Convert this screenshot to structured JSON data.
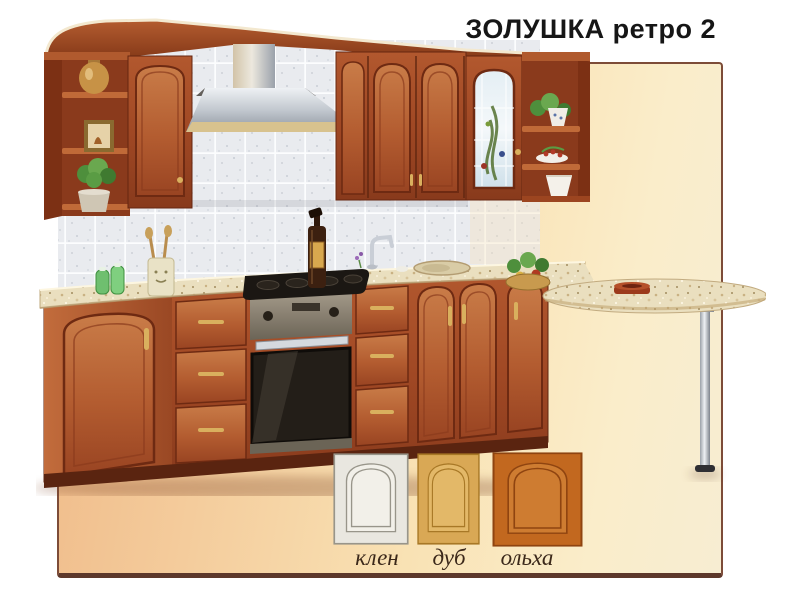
{
  "header": {
    "title": "ЗОЛУШКА ретро 2"
  },
  "panel": {
    "border_color": "#7d4c38",
    "background_left": "#efb886",
    "background_right": "#f7edd2"
  },
  "photo": {
    "label": "Кухня ЗОЛУШКА ретро 2",
    "objects": [
      "corner-shelf-left",
      "tall-wall-cabinet",
      "range-hood",
      "wall-cabinets",
      "glass-door-cabinet",
      "corner-shelf-right",
      "tile-backsplash",
      "countertop",
      "gas-cooktop",
      "built-in-oven",
      "drawer-units",
      "sink",
      "faucet",
      "base-corner-cabinet",
      "sink-base-cabinet",
      "end-base-cabinet",
      "bar-table",
      "chrome-bar-leg",
      "oil-bottle",
      "utensil-cup",
      "salt-pepper-shakers",
      "plant-pot",
      "picture-frame",
      "vase",
      "vegetable-basket",
      "ashtray"
    ],
    "palette": {
      "wood": "#a04824",
      "wood_dark": "#7c3014",
      "wood_light": "#c06a38",
      "countertop": "#eadfbf",
      "tiles": "#e9ebef",
      "stainless": "#b9bfc7",
      "brass": "#d9b05e"
    }
  },
  "finishes": {
    "label_color": "#3b281a",
    "items": [
      {
        "label": "клен",
        "base": "#e9e7e0",
        "panel": "#f2f0e9",
        "line": "#98958a"
      },
      {
        "label": "дуб",
        "base": "#d9a855",
        "panel": "#e3b868",
        "line": "#a87826"
      },
      {
        "label": "ольха",
        "base": "#c2681f",
        "panel": "#ce7c31",
        "line": "#8f4410"
      }
    ]
  }
}
